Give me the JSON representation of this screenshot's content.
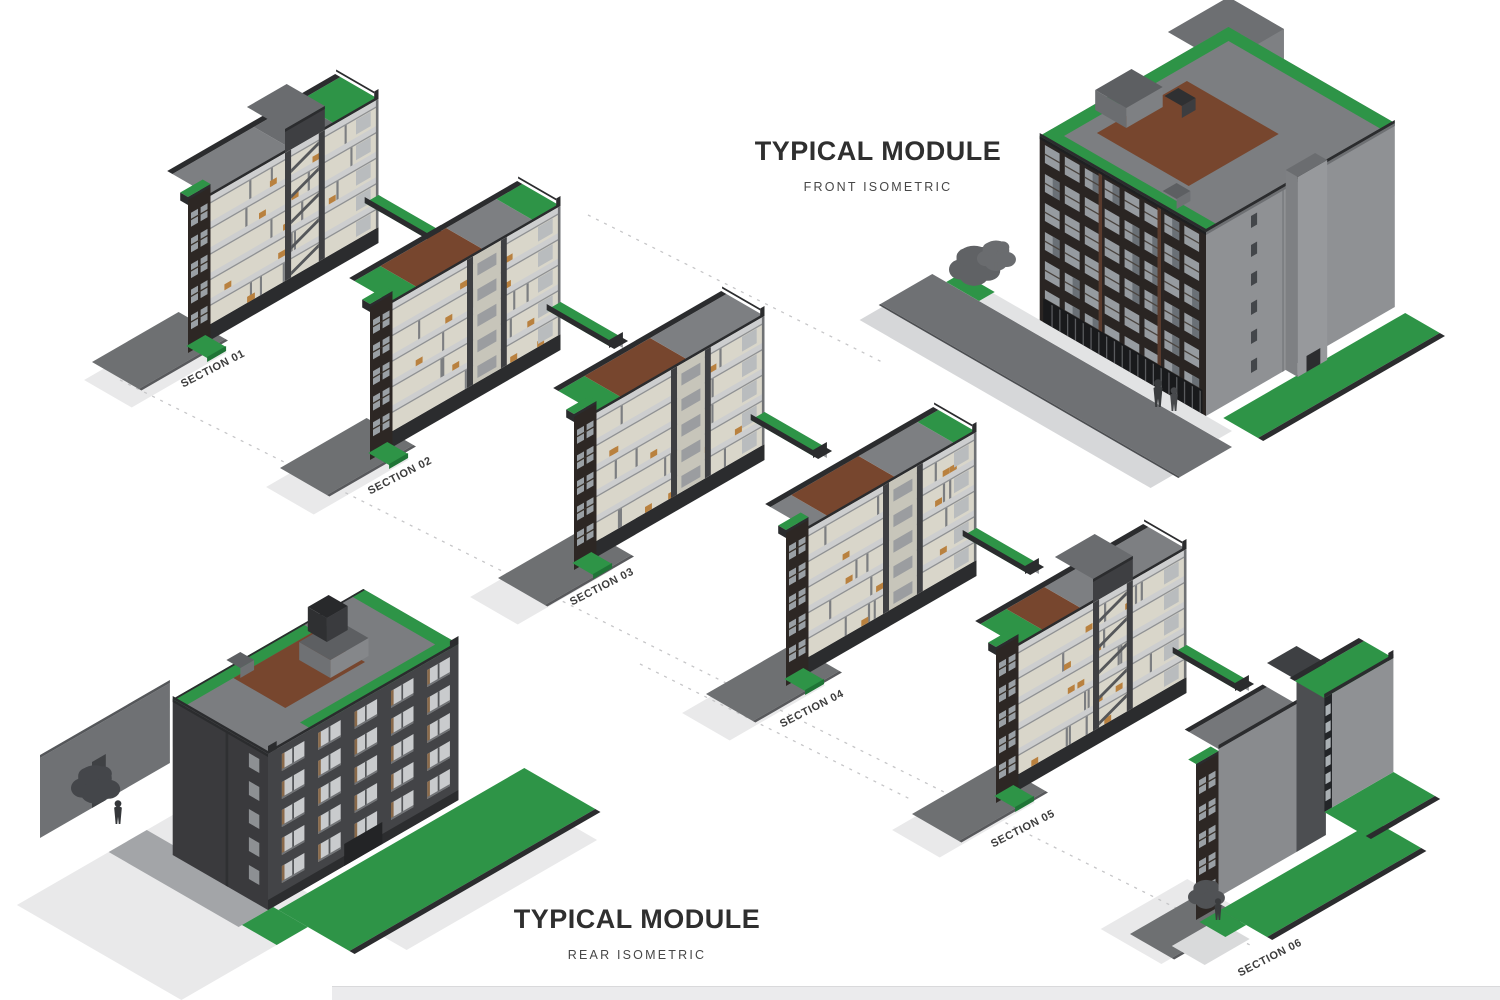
{
  "title_blocks": {
    "front": {
      "title": "TYPICAL MODULE",
      "subtitle": "FRONT ISOMETRIC"
    },
    "rear": {
      "title": "TYPICAL MODULE",
      "subtitle": "REAR ISOMETRIC"
    }
  },
  "sections": [
    {
      "label": "SECTION 01"
    },
    {
      "label": "SECTION 02"
    },
    {
      "label": "SECTION 03"
    },
    {
      "label": "SECTION 04"
    },
    {
      "label": "SECTION 05"
    },
    {
      "label": "SECTION 06"
    }
  ],
  "colors": {
    "green": "#2e9447",
    "greenDark": "#1f7436",
    "brown": "#77462e",
    "roofGray": "#7d7f82",
    "roofGrayDark": "#6a6c6f",
    "charcoal": "#2b2c2e",
    "darkWall": "#3e3f42",
    "facadeDark": "#2d2724",
    "cream": "#d9d6ca",
    "slab": "#cdcecf",
    "glass": "#9aa0a5",
    "wood": "#b9813f",
    "pad": "#6e7072",
    "shadow": "#e9e9ea",
    "line": "#c6c6c8",
    "text": "#2e2e2e"
  }
}
